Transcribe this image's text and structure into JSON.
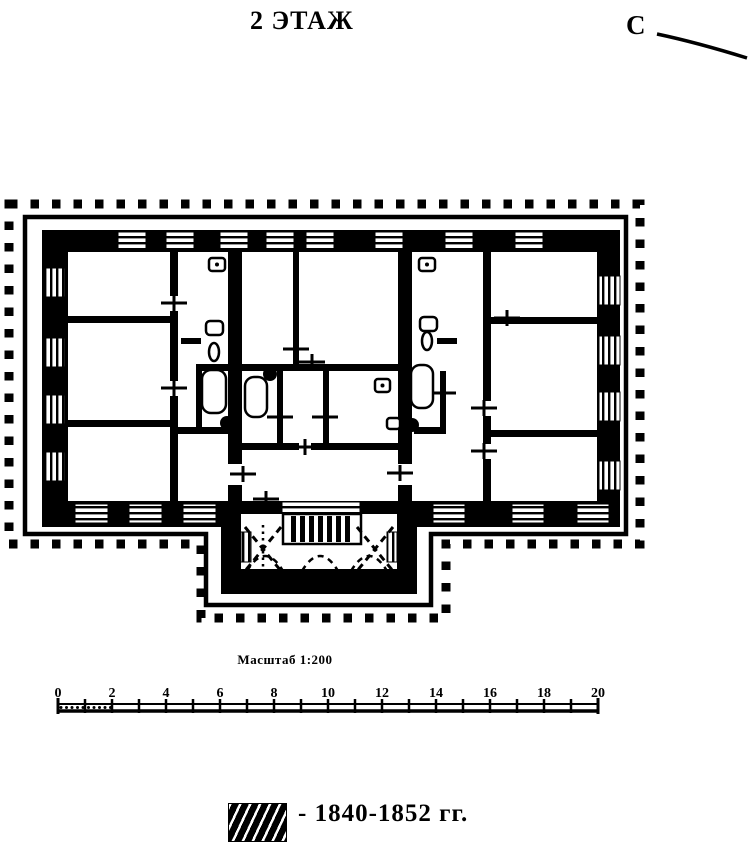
{
  "title": "2 ЭТАЖ",
  "compass": {
    "label": "С"
  },
  "scale_bar": {
    "caption": "Масштаб 1:200",
    "unit_labels": [
      "0",
      "2",
      "4",
      "6",
      "8",
      "10",
      "12",
      "14",
      "16",
      "18",
      "20"
    ],
    "units_total": 20
  },
  "legend": {
    "swatch": "diagonal-hatch",
    "label": "- 1840-1852 гг."
  },
  "colors": {
    "ink": "#000000",
    "paper": "#ffffff"
  }
}
